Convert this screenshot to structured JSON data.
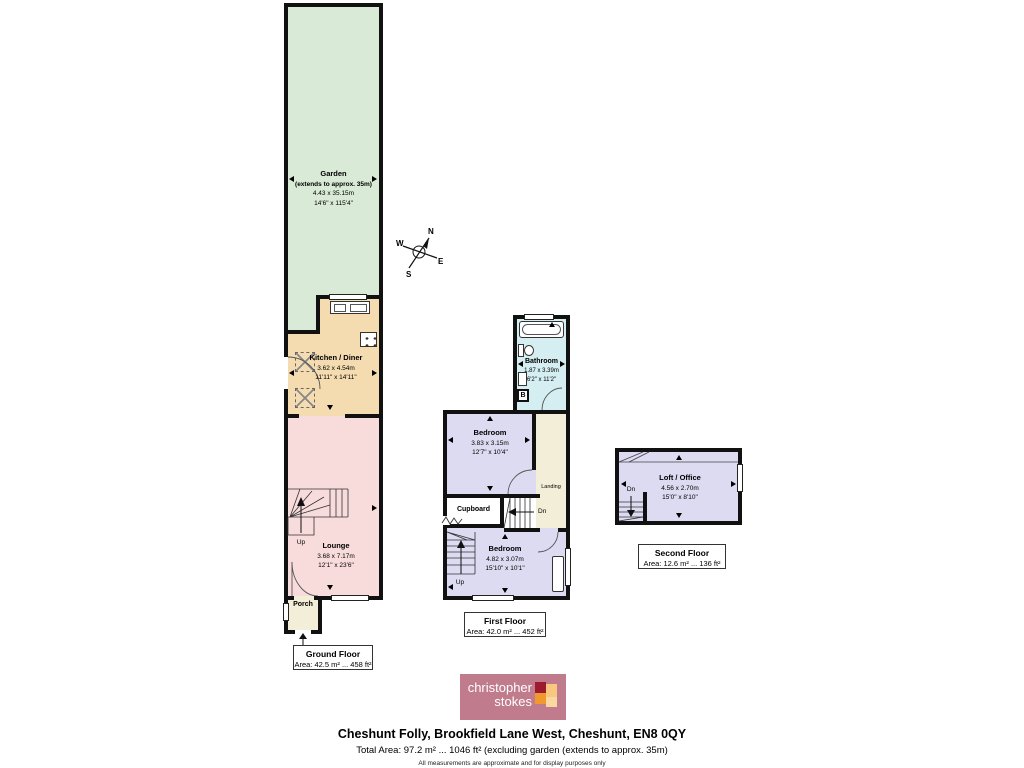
{
  "rooms": {
    "garden": {
      "name": "Garden",
      "note": "(extends to approx. 35m)",
      "metric": "4.43 x 35.15m",
      "imperial": "14'6\" x 115'4\""
    },
    "kitchen": {
      "name": "Kitchen / Diner",
      "metric": "3.62 x 4.54m",
      "imperial": "11'11\" x 14'11\""
    },
    "lounge": {
      "name": "Lounge",
      "metric": "3.68 x 7.17m",
      "imperial": "12'1\" x 23'6\""
    },
    "porch": {
      "name": "Porch"
    },
    "bathroom": {
      "name": "Bathroom",
      "metric": "1.87 x 3.39m",
      "imperial": "6'2\" x 11'2\""
    },
    "bedroom_front": {
      "name": "Bedroom",
      "metric": "3.83 x 3.15m",
      "imperial": "12'7\" x 10'4\""
    },
    "bedroom_back": {
      "name": "Bedroom",
      "metric": "4.82 x 3.07m",
      "imperial": "15'10\" x 10'1\""
    },
    "cupboard": {
      "name": "Cupboard"
    },
    "landing": {
      "name": "Landing"
    },
    "loft": {
      "name": "Loft / Office",
      "metric": "4.56 x 2.70m",
      "imperial": "15'0\" x 8'10\""
    }
  },
  "floors": {
    "ground": {
      "title": "Ground Floor",
      "area": "Area: 42.5 m² ... 458 ft²"
    },
    "first": {
      "title": "First Floor",
      "area": "Area: 42.0 m² ... 452 ft²"
    },
    "second": {
      "title": "Second Floor",
      "area": "Area: 12.6 m² ... 136 ft²"
    }
  },
  "markers": {
    "up": "Up",
    "down": "Dn",
    "in": "In",
    "boiler": "B"
  },
  "compass": {
    "north": "N",
    "east": "E",
    "south": "S",
    "west": "W"
  },
  "logo": {
    "line1": "christopher",
    "line2": "stokes"
  },
  "footer": {
    "address": "Cheshunt Folly, Brookfield Lane West, Cheshunt, EN8 0QY",
    "total_area": "Total Area: 97.2 m² ... 1046 ft² (excluding garden (extends to approx. 35m)",
    "disclaimer": "All measurements are approximate and for display purposes only"
  },
  "colors": {
    "garden": "#d9ead6",
    "kitchen": "#f4dcb0",
    "lounge": "#f8dcdc",
    "hall": "#f3eed8",
    "bathroom": "#d4eef1",
    "bedroom": "#dcdbf1",
    "wall": "#111111",
    "logo_bg": "#c07b8d"
  }
}
